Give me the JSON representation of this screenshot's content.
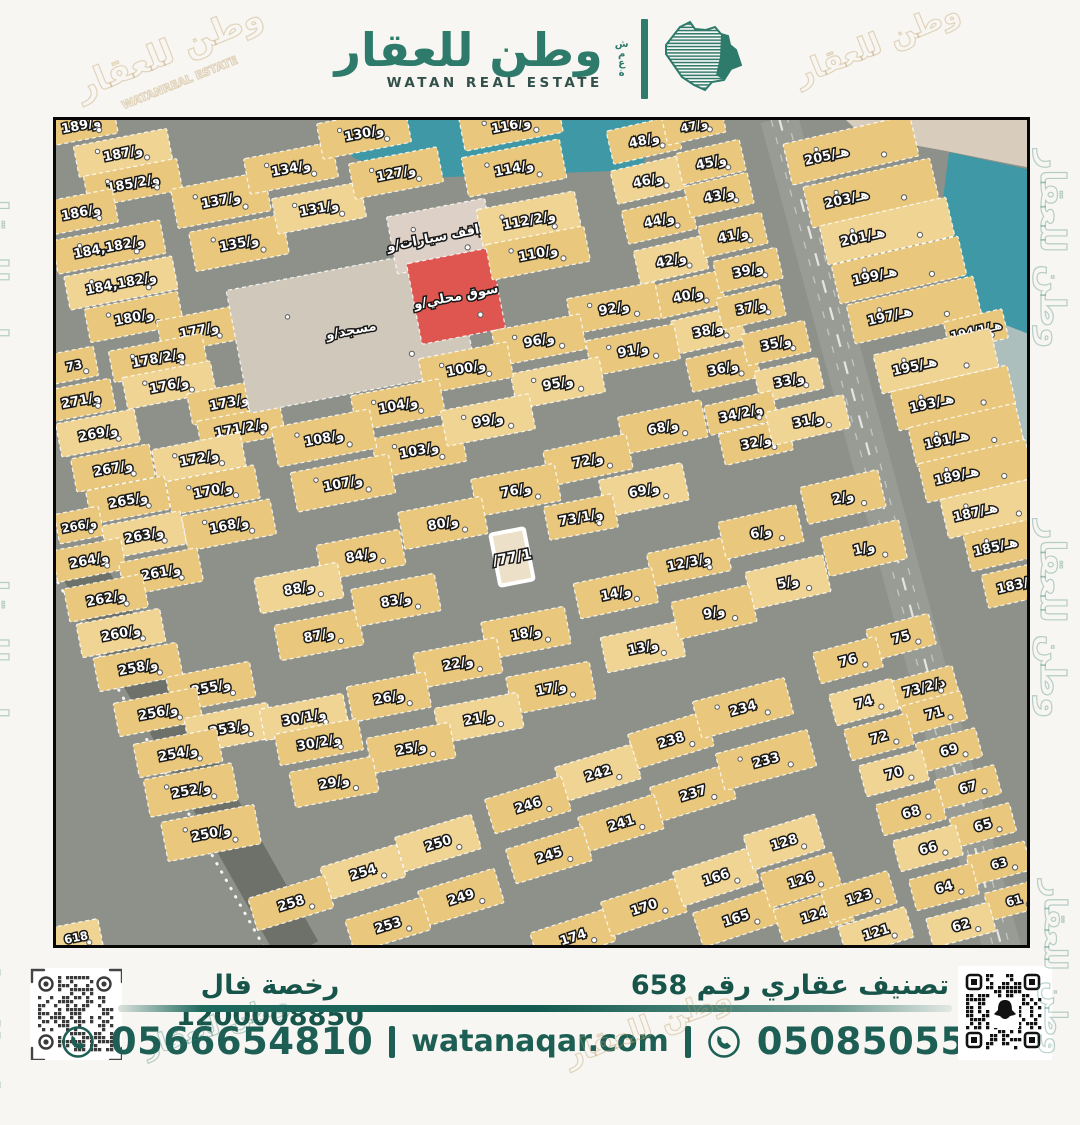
{
  "header": {
    "brand_ar": "وطن للعقار",
    "brand_en": "WATAN REAL ESTATE",
    "side_letters": "شمعة"
  },
  "footer": {
    "license_label": "رخصة فال 1200008850",
    "classification_label": "تصنيف عقاري رقم 658",
    "phone_left": "0566654810",
    "phone_right": "0508505505",
    "website": "watanaqar.com",
    "accent_color": "#1d5f54"
  },
  "watermark": {
    "text_ar": "وطن للعقار",
    "text_en": "WATANREAL ESTATE"
  },
  "watermarks": [
    {
      "t": "وطن للعقار",
      "x": 14,
      "y": 180,
      "r": 90,
      "s": 34,
      "c": ""
    },
    {
      "t": "وطن للعقار",
      "x": 14,
      "y": 560,
      "r": 90,
      "s": 34,
      "c": ""
    },
    {
      "t": "وطن للعقار",
      "x": 4,
      "y": 950,
      "r": 90,
      "s": 30,
      "c": ""
    },
    {
      "t": "وطن للعقار",
      "x": 1072,
      "y": 150,
      "r": 90,
      "s": 34,
      "c": ""
    },
    {
      "t": "وطن للعقار",
      "x": 1072,
      "y": 520,
      "r": 90,
      "s": 34,
      "c": ""
    },
    {
      "t": "وطن للعقار",
      "x": 1072,
      "y": 880,
      "r": 90,
      "s": 30,
      "c": ""
    },
    {
      "t": "وطن للعقار",
      "x": 70,
      "y": 70,
      "r": -22,
      "s": 34,
      "c": "beige"
    },
    {
      "t": "وطن للعقار",
      "x": 790,
      "y": 60,
      "r": -22,
      "s": 30,
      "c": "beige"
    },
    {
      "t": "WATANREAL ESTATE",
      "x": 120,
      "y": 100,
      "r": -22,
      "s": 11,
      "c": "beige"
    },
    {
      "t": "وطن للعقار",
      "x": 560,
      "y": 1040,
      "r": -20,
      "s": 30,
      "c": "beige"
    },
    {
      "t": "وطن للعقار",
      "x": 140,
      "y": 1035,
      "r": -18,
      "s": 26,
      "c": ""
    }
  ],
  "map": {
    "colors": {
      "road": "#8e918a",
      "roadDark": "#6d716a",
      "arterial": "#999c95",
      "p": "#e9c87d",
      "p2": "#f0d494",
      "m": "#cfc8bb",
      "k": "#ddd0c6",
      "r": "#df5550",
      "hl": "#ece0c8",
      "water": "#3f98a6",
      "sand": "#d8ccbc",
      "pale": "#adbfbc",
      "labelFill": "#ffffff",
      "labelStroke": "#191919"
    },
    "areas": [
      {
        "pts": "338,120 658,120 640,170 420,178 352,158",
        "f": "water"
      },
      {
        "pts": "845,120 1030,120 1030,168 940,150 862,136",
        "f": "sand"
      },
      {
        "pts": "948,152 1030,170 1030,335 972,312 938,230",
        "f": "water"
      },
      {
        "pts": "972,312 1030,335 1030,470 1002,452",
        "f": "pale"
      }
    ],
    "roads": [
      {
        "x1": 778,
        "y1": 118,
        "x2": 1002,
        "y2": 952,
        "w": 38,
        "f": "arterial",
        "lanes": true
      },
      {
        "x1": 72,
        "y1": 552,
        "x2": 298,
        "y2": 952,
        "w": 44,
        "f": "roadDark",
        "dotted": true
      }
    ],
    "parcels": [
      [
        "و/189",
        80,
        125,
        70,
        30
      ],
      [
        "و/187",
        122,
        153,
        95,
        32
      ],
      [
        "و/185/2",
        132,
        183,
        95,
        32
      ],
      [
        "و/186",
        80,
        212,
        70,
        34
      ],
      [
        "و/184,182",
        108,
        247,
        110,
        34
      ],
      [
        "و/184,182",
        120,
        283,
        110,
        34
      ],
      [
        "و/180",
        133,
        317,
        95,
        34
      ],
      [
        "و/177",
        198,
        330,
        80,
        34
      ],
      [
        "و/178/2",
        157,
        358,
        95,
        32
      ],
      [
        "و/176",
        168,
        385,
        90,
        32
      ],
      [
        "73",
        73,
        365,
        45,
        30
      ],
      [
        "و/173",
        228,
        402,
        80,
        32
      ],
      [
        "و/171/2",
        240,
        428,
        85,
        30
      ],
      [
        "و/172",
        198,
        458,
        90,
        34
      ],
      [
        "و/170",
        212,
        490,
        90,
        34
      ],
      [
        "و/168",
        228,
        525,
        90,
        36
      ],
      [
        "و/271",
        80,
        400,
        65,
        32
      ],
      [
        "و/269",
        97,
        433,
        80,
        34
      ],
      [
        "و/267",
        112,
        468,
        80,
        34
      ],
      [
        "و/265",
        127,
        500,
        80,
        34
      ],
      [
        "و/266",
        78,
        525,
        45,
        30
      ],
      [
        "و/263",
        143,
        535,
        80,
        34
      ],
      [
        "و/264",
        88,
        560,
        70,
        32
      ],
      [
        "و/261",
        160,
        572,
        80,
        34
      ],
      [
        "و/262",
        105,
        598,
        80,
        34
      ],
      [
        "و/260",
        120,
        633,
        85,
        34
      ],
      [
        "و/258",
        137,
        667,
        85,
        34
      ],
      [
        "و/255",
        210,
        687,
        85,
        36
      ],
      [
        "و/256",
        157,
        712,
        85,
        34
      ],
      [
        "و/253",
        228,
        728,
        85,
        36
      ],
      [
        "و/254",
        177,
        753,
        85,
        34
      ],
      [
        "و/252",
        190,
        790,
        90,
        38
      ],
      [
        "و/250",
        210,
        833,
        95,
        40
      ],
      [
        "618",
        75,
        937,
        50,
        28
      ],
      [
        "و/137",
        220,
        200,
        95,
        40
      ],
      [
        "و/135",
        238,
        243,
        95,
        40
      ],
      [
        "و/134",
        290,
        168,
        90,
        36
      ],
      [
        "و/131",
        318,
        208,
        90,
        36
      ],
      [
        "و/130",
        363,
        133,
        90,
        36
      ],
      [
        "و/127",
        395,
        173,
        90,
        36
      ],
      [
        "مسجد/و",
        350,
        330,
        230,
        125,
        -11,
        "m"
      ],
      [
        "مواقف سيارات/و",
        440,
        236,
        100,
        58,
        -11,
        "k"
      ],
      [
        "سوق محلي/و",
        455,
        296,
        85,
        82,
        -11,
        "r"
      ],
      [
        "و/116",
        510,
        125,
        100,
        34
      ],
      [
        "و/114",
        513,
        168,
        100,
        40
      ],
      [
        "و/112/2",
        528,
        220,
        100,
        40
      ],
      [
        "و/110",
        537,
        253,
        100,
        36
      ],
      [
        "و/48",
        643,
        140,
        70,
        34,
        -13
      ],
      [
        "و/47",
        693,
        125,
        60,
        28,
        -13
      ],
      [
        "و/46",
        647,
        180,
        70,
        34,
        -13
      ],
      [
        "و/45",
        710,
        162,
        65,
        32,
        -13
      ],
      [
        "و/44",
        658,
        220,
        70,
        34,
        -13
      ],
      [
        "و/43",
        718,
        195,
        65,
        32,
        -13
      ],
      [
        "و/42",
        670,
        260,
        70,
        34,
        -13
      ],
      [
        "و/41",
        732,
        235,
        65,
        32,
        -13
      ],
      [
        "و/40",
        687,
        295,
        70,
        34,
        -13
      ],
      [
        "و/39",
        747,
        270,
        65,
        32,
        -13
      ],
      [
        "و/38",
        707,
        330,
        70,
        34,
        -13
      ],
      [
        "و/37",
        750,
        307,
        65,
        32,
        -13
      ],
      [
        "و/36",
        722,
        368,
        70,
        34,
        -13
      ],
      [
        "و/35",
        775,
        343,
        65,
        32,
        -13
      ],
      [
        "و/33",
        788,
        380,
        65,
        32,
        -13
      ],
      [
        "و/92",
        613,
        308,
        90,
        36
      ],
      [
        "و/91",
        632,
        350,
        90,
        36
      ],
      [
        "و/96",
        538,
        340,
        90,
        36
      ],
      [
        "و/95",
        557,
        383,
        90,
        36
      ],
      [
        "و/100",
        465,
        368,
        90,
        36
      ],
      [
        "و/104",
        397,
        405,
        90,
        36
      ],
      [
        "و/103",
        418,
        450,
        90,
        40
      ],
      [
        "و/99",
        487,
        420,
        90,
        36
      ],
      [
        "و/108",
        323,
        438,
        100,
        40
      ],
      [
        "و/107",
        342,
        483,
        100,
        40
      ],
      [
        "و/84",
        360,
        555,
        85,
        36
      ],
      [
        "و/88",
        298,
        588,
        85,
        36
      ],
      [
        "و/87",
        318,
        635,
        85,
        36
      ],
      [
        "و/68",
        662,
        427,
        85,
        38,
        -12
      ],
      [
        "و/72",
        587,
        460,
        85,
        36,
        -12
      ],
      [
        "و/69",
        643,
        490,
        85,
        38,
        -12
      ],
      [
        "و/76",
        515,
        490,
        85,
        38
      ],
      [
        "و/73/1",
        580,
        517,
        70,
        34
      ],
      [
        "و/80",
        442,
        523,
        85,
        38
      ],
      [
        "/77/1",
        511,
        557,
        34,
        52,
        -11,
        "hl"
      ],
      [
        "و/83",
        395,
        600,
        85,
        38
      ],
      [
        "و/12/3",
        688,
        562,
        80,
        34,
        -12
      ],
      [
        "و/14",
        615,
        593,
        80,
        36,
        -12
      ],
      [
        "و/13",
        642,
        647,
        80,
        36,
        -12
      ],
      [
        "و/18",
        525,
        633,
        85,
        38
      ],
      [
        "و/22",
        457,
        663,
        85,
        36
      ],
      [
        "و/17",
        550,
        688,
        85,
        38
      ],
      [
        "و/21",
        478,
        718,
        85,
        36
      ],
      [
        "و/26",
        388,
        697,
        80,
        36
      ],
      [
        "و/25",
        410,
        748,
        85,
        36
      ],
      [
        "و/29",
        333,
        782,
        85,
        36
      ],
      [
        "و/30/1",
        303,
        717,
        85,
        32
      ],
      [
        "و/30/2",
        318,
        742,
        85,
        32
      ],
      [
        "و/34/2",
        740,
        413,
        70,
        30,
        -13
      ],
      [
        "و/32",
        755,
        442,
        70,
        32,
        -13
      ],
      [
        "و/31",
        807,
        420,
        80,
        34,
        -13
      ],
      [
        "و/2",
        842,
        497,
        80,
        38,
        -13
      ],
      [
        "و/6",
        760,
        532,
        80,
        38,
        -13
      ],
      [
        "و/1",
        863,
        548,
        80,
        40,
        -13
      ],
      [
        "و/5",
        787,
        582,
        80,
        38,
        -13
      ],
      [
        "و/9",
        713,
        612,
        80,
        38,
        -13
      ],
      [
        "هـ/205",
        850,
        150,
        130,
        42,
        -13,
        "p",
        -25
      ],
      [
        "هـ/203",
        870,
        193,
        130,
        42,
        -13,
        "p",
        -25
      ],
      [
        "هـ/201",
        886,
        231,
        130,
        40,
        -13,
        "p",
        -25
      ],
      [
        "هـ/199",
        898,
        270,
        130,
        40,
        -13,
        "p",
        -25
      ],
      [
        "هـ/197",
        913,
        310,
        130,
        40,
        -13,
        "p",
        -25
      ],
      [
        "هـ/194/1",
        975,
        330,
        60,
        30,
        -13
      ],
      [
        "هـ/195",
        935,
        361,
        120,
        40,
        -13,
        "p",
        -22
      ],
      [
        "هـ/193",
        952,
        398,
        120,
        40,
        -13,
        "p",
        -22
      ],
      [
        "هـ/191",
        965,
        435,
        110,
        40,
        -13,
        "p",
        -20
      ],
      [
        "هـ/189",
        975,
        471,
        110,
        40,
        -13,
        "p",
        -20
      ],
      [
        "هـ/187",
        992,
        508,
        100,
        40,
        -13,
        "p",
        -18
      ],
      [
        "هـ/185",
        1010,
        543,
        90,
        38,
        -13,
        "p",
        -16
      ],
      [
        "هـ/183",
        1018,
        584,
        70,
        34,
        -13
      ],
      [
        "238",
        670,
        740,
        80,
        36,
        -17
      ],
      [
        "242",
        597,
        773,
        80,
        36,
        -17
      ],
      [
        "237",
        692,
        793,
        80,
        36,
        -17
      ],
      [
        "246",
        527,
        805,
        80,
        36,
        -17
      ],
      [
        "241",
        620,
        823,
        80,
        36,
        -17
      ],
      [
        "250",
        437,
        843,
        80,
        36,
        -17
      ],
      [
        "245",
        548,
        855,
        80,
        36,
        -17
      ],
      [
        "249",
        460,
        897,
        80,
        36,
        -17
      ],
      [
        "253",
        387,
        925,
        80,
        34,
        -17
      ],
      [
        "254",
        362,
        872,
        80,
        34,
        -17
      ],
      [
        "258",
        290,
        903,
        80,
        34,
        -17
      ],
      [
        "174",
        572,
        937,
        80,
        34,
        -18
      ],
      [
        "170",
        643,
        907,
        80,
        36,
        -18
      ],
      [
        "166",
        715,
        877,
        80,
        36,
        -18
      ],
      [
        "165",
        735,
        918,
        80,
        36,
        -18
      ],
      [
        "234",
        742,
        708,
        95,
        38,
        -15
      ],
      [
        "233",
        765,
        760,
        95,
        38,
        -15
      ],
      [
        "128",
        783,
        842,
        75,
        36,
        -17
      ],
      [
        "126",
        800,
        880,
        75,
        36,
        -17
      ],
      [
        "124",
        813,
        915,
        75,
        34,
        -17
      ],
      [
        "123",
        858,
        897,
        70,
        34,
        -17
      ],
      [
        "121",
        875,
        932,
        70,
        32,
        -17
      ],
      [
        "75",
        900,
        637,
        65,
        32,
        -15
      ],
      [
        "76",
        847,
        660,
        65,
        32,
        -15
      ],
      [
        "د/73/2",
        923,
        687,
        65,
        28,
        -15
      ],
      [
        "74",
        863,
        702,
        65,
        32,
        -15
      ],
      [
        "71",
        933,
        713,
        62,
        30,
        -15
      ],
      [
        "72",
        878,
        737,
        65,
        32,
        -15
      ],
      [
        "69",
        948,
        750,
        62,
        30,
        -15
      ],
      [
        "70",
        893,
        773,
        65,
        32,
        -15
      ],
      [
        "67",
        967,
        787,
        62,
        30,
        -15
      ],
      [
        "68",
        910,
        812,
        65,
        32,
        -15
      ],
      [
        "65",
        982,
        825,
        62,
        30,
        -15
      ],
      [
        "66",
        927,
        848,
        65,
        32,
        -15
      ],
      [
        "63",
        998,
        863,
        60,
        30,
        -15
      ],
      [
        "64",
        943,
        887,
        65,
        32,
        -15
      ],
      [
        "61",
        1013,
        900,
        55,
        28,
        -15
      ],
      [
        "62",
        960,
        925,
        65,
        30,
        -15
      ]
    ]
  }
}
